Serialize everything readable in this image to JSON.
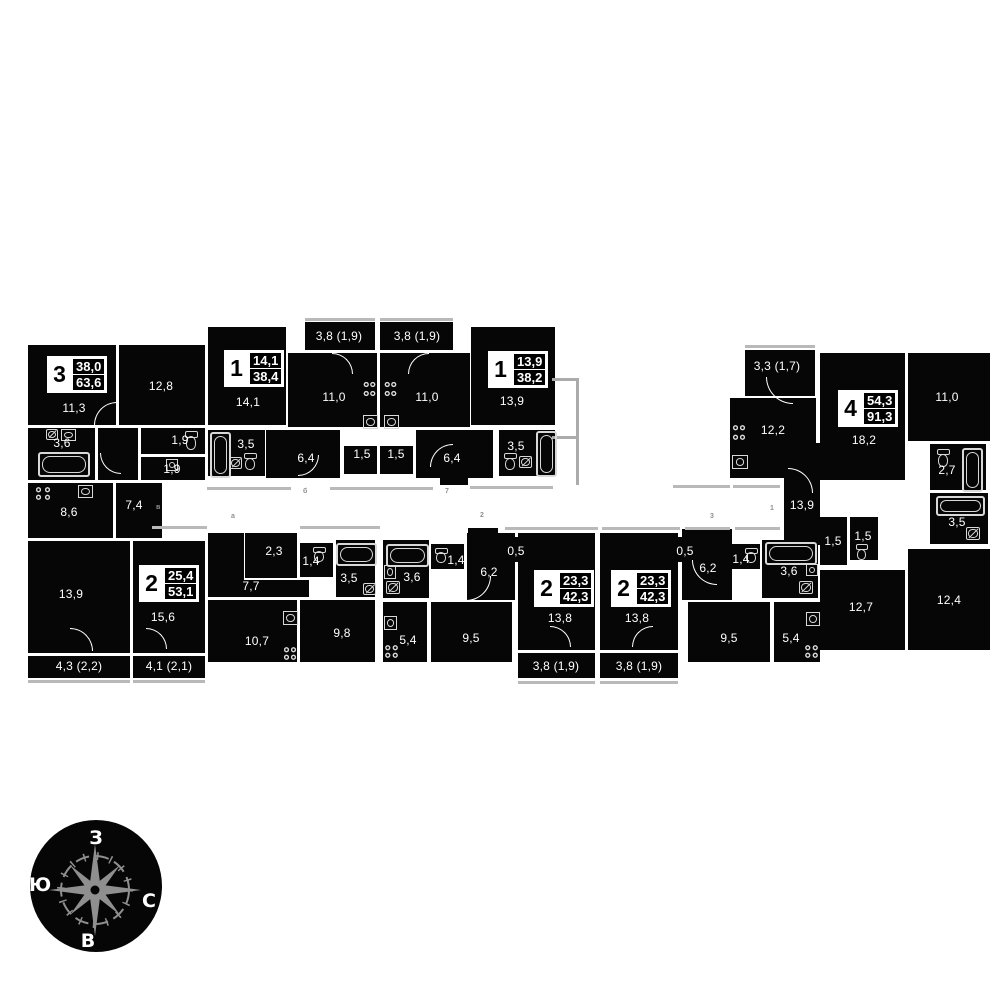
{
  "apartments": {
    "apt3": {
      "type": "3",
      "living": "38,0",
      "total": "63,6"
    },
    "apt2a": {
      "type": "2",
      "living": "25,4",
      "total": "53,1"
    },
    "apt1a": {
      "type": "1",
      "living": "14,1",
      "total": "38,4"
    },
    "apt1b": {
      "type": "1",
      "living": "13,9",
      "total": "38,2"
    },
    "apt4": {
      "type": "4",
      "living": "54,3",
      "total": "91,3"
    },
    "apt2b": {
      "type": "2",
      "living": "23,3",
      "total": "42,3"
    },
    "apt2c": {
      "type": "2",
      "living": "23,3",
      "total": "42,3"
    }
  },
  "areas": {
    "apt3": {
      "room1": "11,3",
      "room2": "12,8",
      "bath": "3,6",
      "wc1": "1,9",
      "wc2": "1,9",
      "kitchen": "8,6",
      "hall": "7,4",
      "room3": "13,9",
      "balcony": "4,3 (2,2)"
    },
    "apt2a": {
      "room1": "15,6",
      "balcony": "4,1 (2,1)",
      "closet": "2,3",
      "hall": "7,7",
      "wc": "1,4",
      "bath": "3,5",
      "kitchen": "10,7",
      "room2": "9,8"
    },
    "apt1a": {
      "room": "14,1",
      "balcony": "3,8 (1,9)",
      "kitchen": "11,0",
      "bath": "3,5",
      "hall": "6,4",
      "closet": "1,5"
    },
    "apt1b": {
      "room": "13,9",
      "balcony": "3,8 (1,9)",
      "kitchen": "11,0",
      "bath": "3,5",
      "hall": "6,4",
      "closet": "1,5"
    },
    "apt4": {
      "balcony": "3,3 (1,7)",
      "kitchen": "12,2",
      "room1": "18,2",
      "room2": "11,0",
      "wc": "2,7",
      "bath": "3,5",
      "hall": "13,9",
      "closet1": "1,5",
      "closet2": "1,5",
      "room3": "12,7",
      "room4": "12,4"
    },
    "apt2b": {
      "bath": "3,6",
      "wc": "1,4",
      "hall": "6,2",
      "niche": "0,5",
      "room1": "13,8",
      "balcony": "3,8 (1,9)",
      "kitchen": "5,4",
      "room2": "9,5"
    },
    "apt2c": {
      "room1": "13,8",
      "balcony": "3,8 (1,9)",
      "niche": "0,5",
      "hall": "6,2",
      "wc": "1,4",
      "bath": "3,6",
      "room2": "9,5",
      "kitchen": "5,4"
    }
  },
  "corridor_marks": [
    "в",
    "а",
    "б",
    "7",
    "2",
    "3",
    "1"
  ],
  "compass": {
    "top": "З",
    "left": "Ю",
    "right": "С",
    "bottom": "В"
  },
  "colors": {
    "wall": "#060606",
    "bg": "#ffffff",
    "text": "#ffffff",
    "gray_line": "#b9b9b9",
    "compass_star": "#8f8f8f"
  }
}
